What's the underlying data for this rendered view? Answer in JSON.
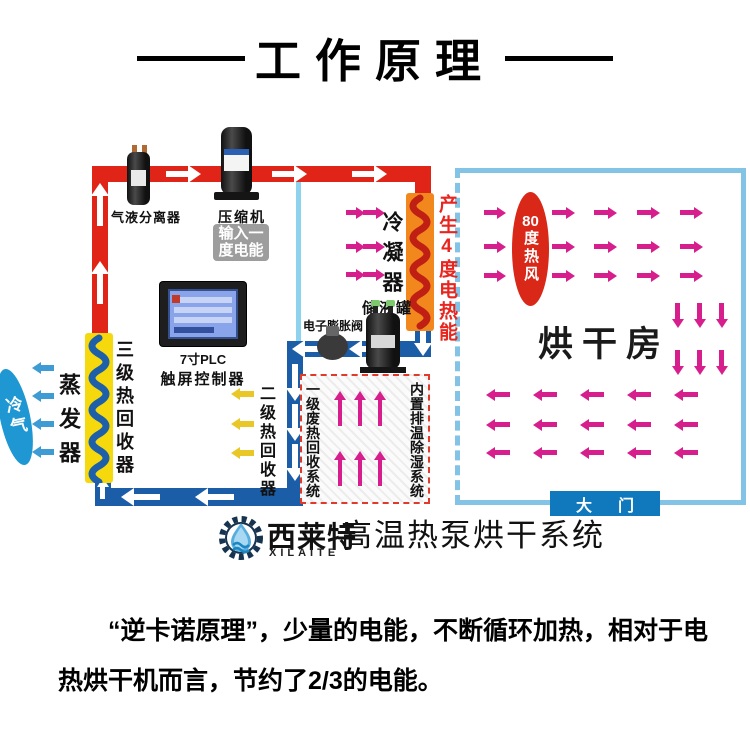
{
  "title": "工作原理",
  "machine": {
    "separator_label": "气液分离器",
    "compressor_label": "压缩机",
    "input_power_line1": "输入一",
    "input_power_line2": "度电能",
    "condenser_label": "冷凝器",
    "heat_output_label": "产生4度电热能",
    "tank_label": "储液罐",
    "valve_label": "电子膨胀阀",
    "plc_label_line1": "7寸PLC",
    "plc_label_line2": "触屏控制器",
    "recovery3_label": "三级热回收器",
    "evaporator_label": "蒸发器",
    "cold_air_label": "冷气",
    "recovery2_label": "二级热回收器",
    "waste_recovery_label": "一级废热回收系统",
    "dehumid_label": "内置排温除湿系统"
  },
  "drying_room": {
    "hot_wind_value": "80",
    "hot_wind_unit": "度热风",
    "room_label": "烘干房",
    "door_label": "大门"
  },
  "footer": {
    "brand_cn": "西莱特",
    "brand_en": "XILAITE",
    "system_name": "高温热泵烘干系统"
  },
  "description": {
    "line1": "“逆卡诺原理”，少量的电能，不断循环加热，相对于电",
    "line2": "热烘干机而言，节约了2/3的电能。"
  },
  "colors": {
    "pipe_hot": "#e02418",
    "pipe_cold": "#1b5ea7",
    "condenser_coil_bg": "#f2871e",
    "condenser_coil": "#c01f14",
    "recovery_coil_bg": "#f5d90c",
    "recovery_coil": "#1d5fa8",
    "arrow_heat": "#d61f8d",
    "arrow_warm": "#e9c727",
    "arrow_cold": "#3f9bd3",
    "hot_oval": "#d92718",
    "cold_oval": "#1e97d2",
    "room_border": "#82c3e6",
    "door_bg": "#1079be",
    "alert_text": "#e8251f"
  }
}
